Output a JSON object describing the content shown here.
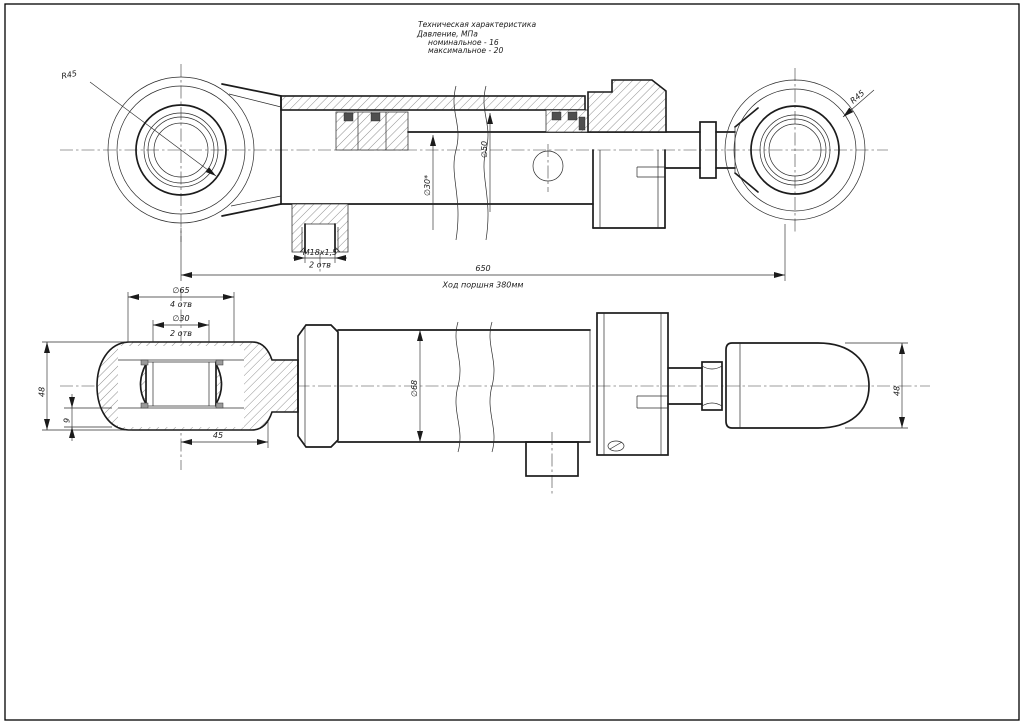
{
  "title_block": {
    "title": "Техническая характеристика",
    "pressure_label": "Давление, МПа",
    "nominal": "номинальное - 16",
    "maximal": "максимальное - 20"
  },
  "top_view": {
    "left_eye_radius": "R45",
    "right_eye_radius": "R45",
    "rod_dia": "∅30*",
    "bore_dia": "∅50",
    "port_thread": "М18х1,5",
    "port_holes_note": "2 отв",
    "overall_length": "650",
    "stroke_note": "Ход поршня 380мм"
  },
  "bottom_view": {
    "housing_dia": "∅65",
    "housing_holes_note": "4 отв",
    "bore_dia": "∅30",
    "bore_holes_note": "2 отв",
    "tube_dia": "∅68",
    "eye_offset": "45",
    "eye_width_left": "48",
    "eye_width_right": "48",
    "plate_thickness": "9"
  }
}
